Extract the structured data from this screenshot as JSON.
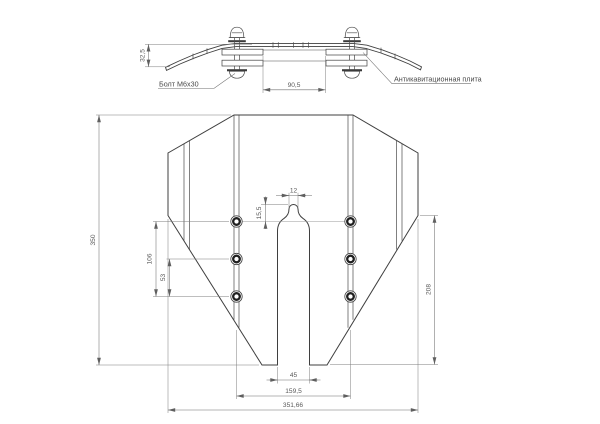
{
  "colors": {
    "line": "#3f3f3f",
    "dimension": "#6f6f6f",
    "text": "#5a5a5a",
    "background": "#ffffff"
  },
  "side_view": {
    "labels": {
      "bolt": "Болт М6х30",
      "plate": "Антикавитационная плита"
    },
    "dims": {
      "tip_height": "32,5",
      "clamp_span": "90,5"
    }
  },
  "front_view": {
    "dims": {
      "overall_height": "350",
      "bolt_rows_span": "106",
      "bolt_row_pitch": "53",
      "slot_tip_offset": "15,5",
      "slot_tip_width": "12",
      "slot_width": "45",
      "bolt_columns_span": "159,5",
      "overall_width": "351,66",
      "right_height": "208"
    }
  }
}
